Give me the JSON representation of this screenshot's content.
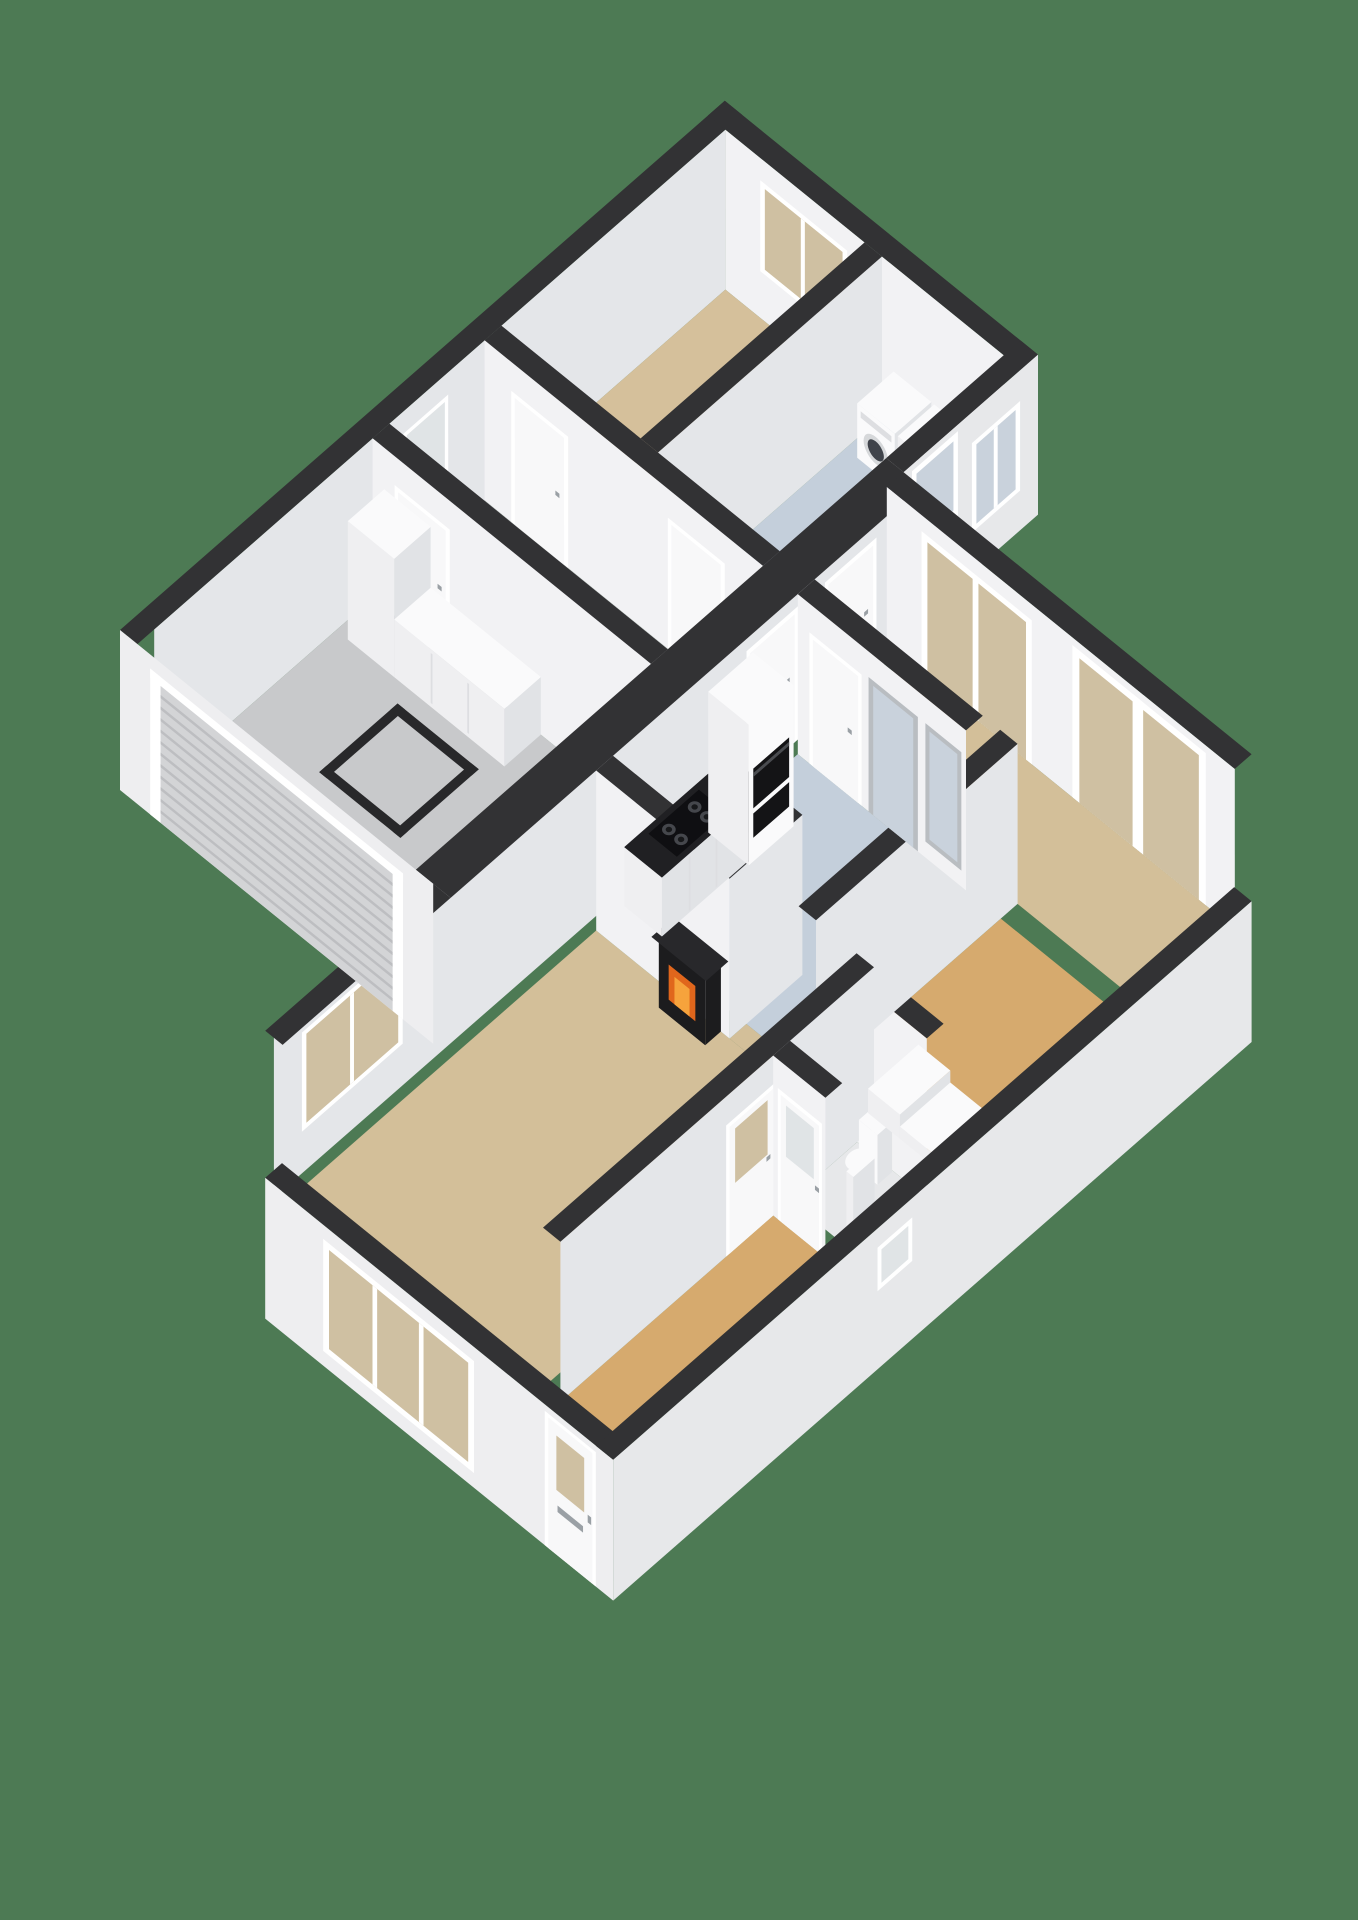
{
  "scene": {
    "title": "3D isometric cutaway floor plan - ground floor",
    "width": 1358,
    "height": 1920,
    "background": "#4d7a54"
  },
  "palette": {
    "bg": "#4d7a54",
    "cap": "#323234",
    "hatch": "#28282a",
    "faceLight": "#f2f2f4",
    "faceShade": "#e4e6e9",
    "outerSW": "#eeeef0",
    "outerSE": "#e7e8ea",
    "topWhite": "#fafafb",
    "boxSW": "#efeff1",
    "boxSE": "#e1e3e6",
    "doorWhite": "#f8f8f9",
    "frame": "#ffffff",
    "frameGray": "#b9bdc1",
    "glassBeige": "#cfc0a2",
    "glassBlue": "#c9d2dc",
    "glassFrost": "#e0e4e6",
    "rollerDoor": "#d3d4d6",
    "rollerSlat": "#bdbec1",
    "counterTop": "#202023",
    "hob": "#0f0f12",
    "burner": "#45474c",
    "burnerCore": "#17181a",
    "ovenBlack": "#141416",
    "ovenTrim": "#4a4c50",
    "fireDark": "#1c1c1e",
    "fireOrange": "#e0661c",
    "fireGlow": "#f6a33c",
    "washerRing": "#d6d8da",
    "washerDoor": "#3f434a",
    "handle": "#9aa0a5",
    "seam": "#dddee1",
    "mantel": "#28282b"
  },
  "rooms": [
    {
      "id": "garage",
      "name": "garage",
      "floor": "#c8c9cb"
    },
    {
      "id": "hallway",
      "name": "hallway",
      "floor": "#d1d2d4"
    },
    {
      "id": "bedroom",
      "name": "bedroom",
      "floor": "#d5c09b"
    },
    {
      "id": "utility-room",
      "name": "utility room",
      "floor": "#c4cfdb"
    },
    {
      "id": "kitchen",
      "name": "kitchen",
      "floor": "#c4cfdb"
    },
    {
      "id": "dining-area",
      "name": "dining area",
      "floor": "#d3bf99"
    },
    {
      "id": "living-room",
      "name": "living room",
      "floor": "#d3bf99"
    },
    {
      "id": "entrance-hall",
      "name": "entrance hall",
      "floor": "#d6aa6e"
    },
    {
      "id": "toilet",
      "name": "toilet",
      "floor": "#e7e8ea"
    }
  ],
  "objects": [
    "garage roller door",
    "attic hatch outline",
    "garage cupboards",
    "frosted side door",
    "bedroom window",
    "washing machine",
    "tumble dryer",
    "utility back door",
    "utility window",
    "outside step",
    "kitchen counter with gas hob",
    "oven column",
    "kitchen doors",
    "glazed room divider",
    "garden glass doors",
    "chimney with fireplace",
    "living room windows",
    "hall door",
    "front door with letterbox",
    "toilet",
    "hand basin shelf",
    "staircase steps",
    "wc window"
  ]
}
